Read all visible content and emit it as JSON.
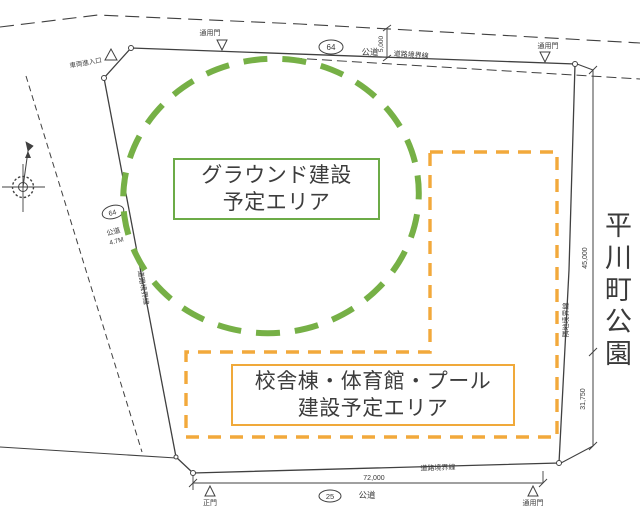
{
  "colors": {
    "line": "#404040",
    "green_dash": "#76b046",
    "green_border": "#6cab47",
    "orange_dash": "#f2a93b",
    "orange_border": "#f0a93a",
    "text": "#3a3a3a"
  },
  "areas": {
    "ground": {
      "line1": "グラウンド建設",
      "line2": "予定エリア"
    },
    "building": {
      "line1": "校舎棟・体育館・プール",
      "line2": "建設予定エリア"
    }
  },
  "labels": {
    "park_vertical": "平川町公園",
    "gate_top_left": "通用門",
    "gate_top_right": "通用門",
    "gate_bottom_main": "正門",
    "gate_bottom_right": "通用門",
    "entrance_left": "車両進入口",
    "road_top": "公道",
    "road_left": "公道",
    "road_left_width": "4.7M",
    "road_bottom": "公道",
    "route_oval_top": "64",
    "route_oval_left": "64",
    "route_oval_bottom": "25",
    "boundary_top": "道路境界線",
    "boundary_left": "道路境界線",
    "boundary_bottom": "道路境界線",
    "boundary_right": "隣地境界線"
  },
  "dimensions": {
    "road_width_top": "5,000",
    "site_width_bottom": "72,000",
    "right_upper": "45,000",
    "right_lower": "31,750"
  }
}
